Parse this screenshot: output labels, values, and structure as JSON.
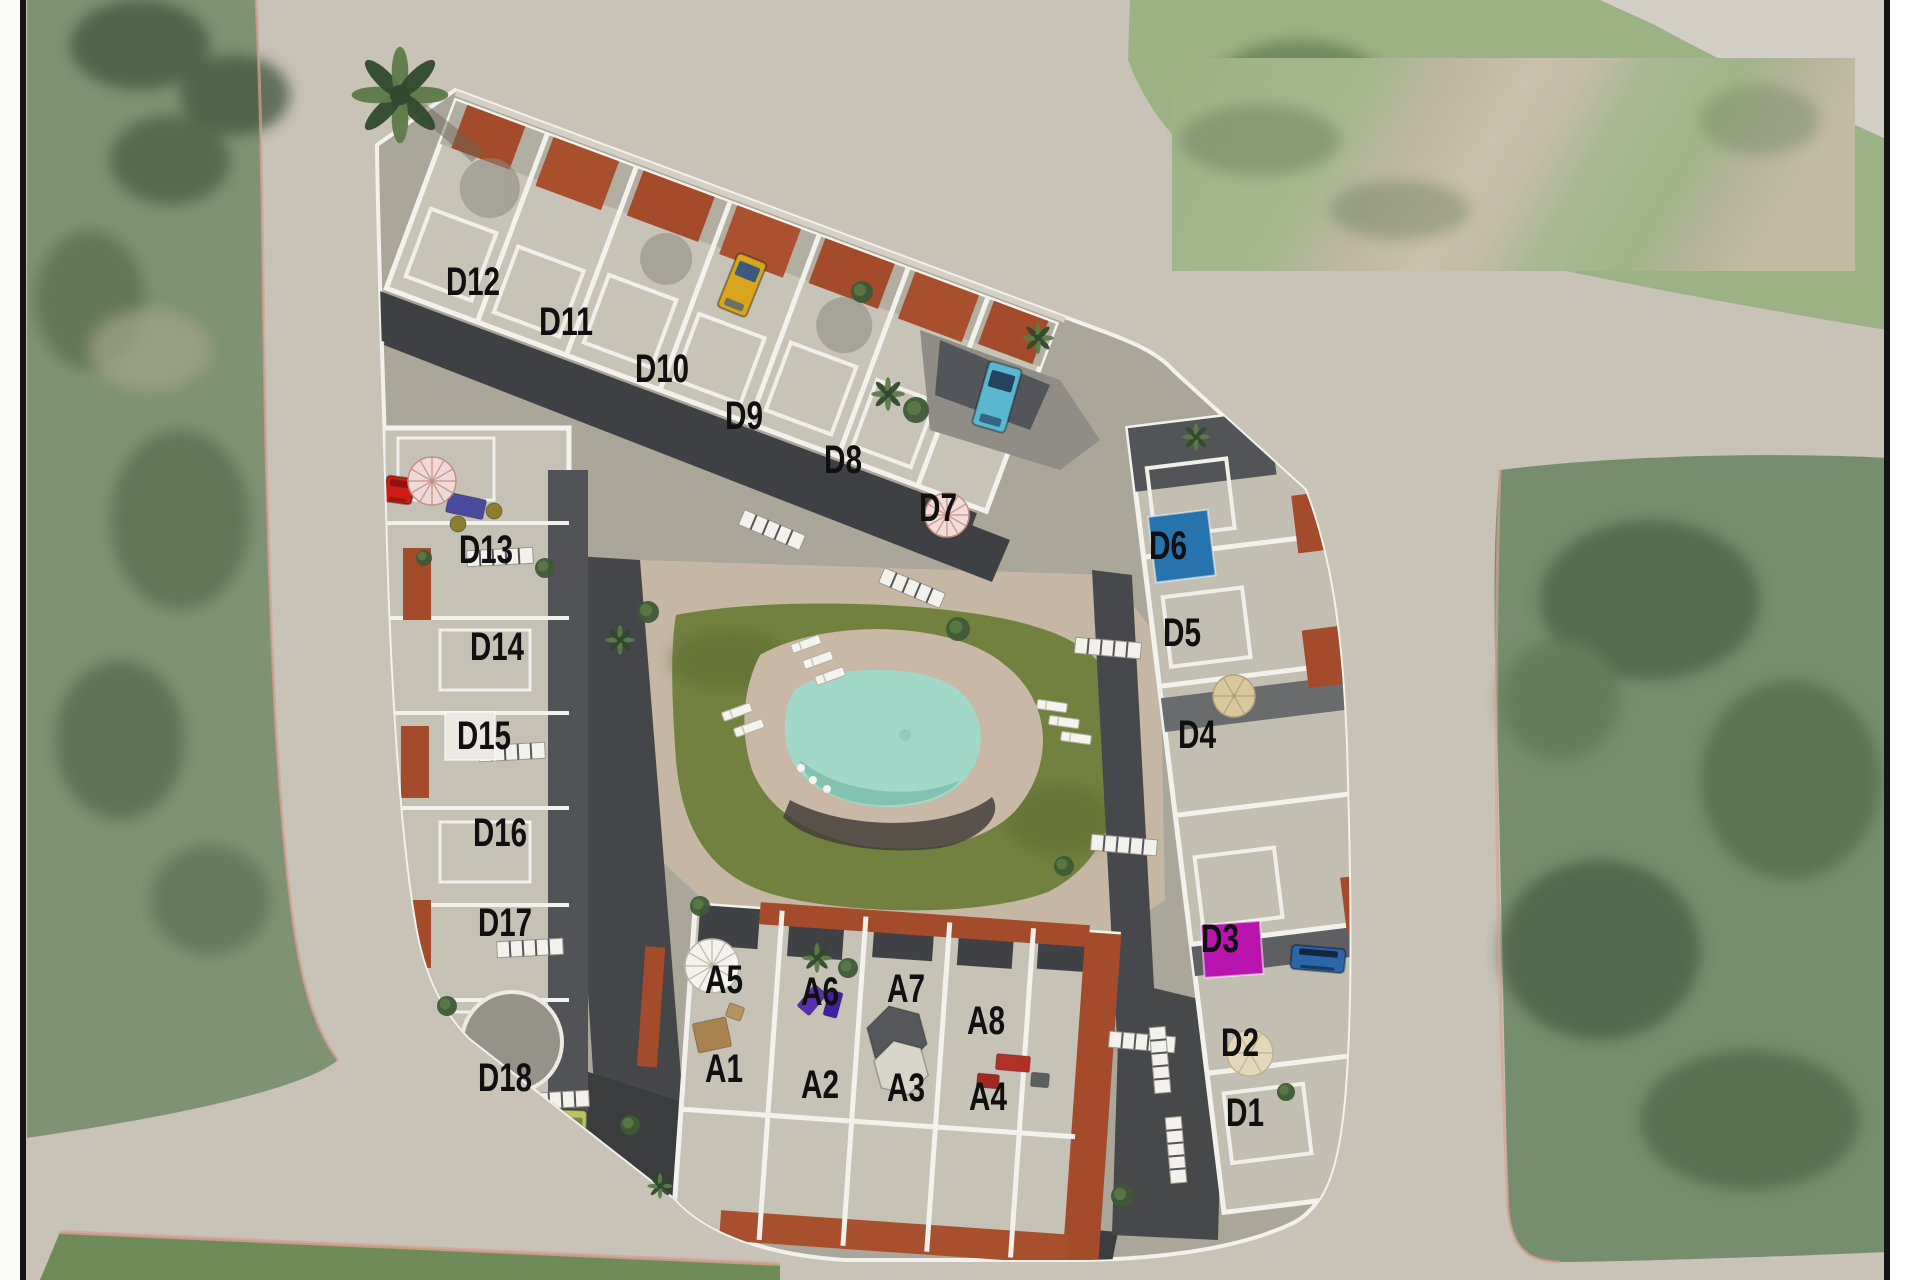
{
  "scene": {
    "width": 1920,
    "height": 1280,
    "kind": "aerial-site-plan",
    "note": "3D rendered residential development over satellite photo with numbered unit labels"
  },
  "palette": {
    "road": "#c8c2b7",
    "road_light": "#d3cfc7",
    "field_left": "#7f9372",
    "field_right": "#768e6b",
    "field_dark": "#4e6547",
    "field_bottom": "#6f8c58",
    "curb_pink": "#d8a193",
    "parcel": "#aaa69a",
    "lane_dark": "#3e4043",
    "building": "#c7c3b6",
    "building_dark": "#b2aea2",
    "wall_white": "#f2f1ec",
    "charcoal": "#4b4d50",
    "charcoal_deep": "#3a3c3e",
    "brick": "#a34b2b",
    "brick_light": "#c06a42",
    "lawn": "#72813f",
    "lawn_dark": "#5d6c33",
    "deck": "#c9b8a5",
    "pool": "#a2d8c8",
    "pool_deep": "#7fc0ae",
    "shadow": "#45403a",
    "label": "#101010",
    "frame_line": "#141414",
    "margin_left": "#fafaf8",
    "margin_right": "#ffffff",
    "palm": "#2f4a2c",
    "bush": "#3e5a36",
    "bush_light": "#5d7a47",
    "paste_green": "#a6b78f",
    "paste_tan": "#c9c1aa"
  },
  "labels": [
    {
      "id": "D12",
      "x": 473,
      "y": 281
    },
    {
      "id": "D11",
      "x": 566,
      "y": 321
    },
    {
      "id": "D10",
      "x": 662,
      "y": 368
    },
    {
      "id": "D9",
      "x": 744,
      "y": 415
    },
    {
      "id": "D8",
      "x": 843,
      "y": 459
    },
    {
      "id": "D7",
      "x": 938,
      "y": 507
    },
    {
      "id": "D13",
      "x": 486,
      "y": 549
    },
    {
      "id": "D14",
      "x": 497,
      "y": 646
    },
    {
      "id": "D15",
      "x": 484,
      "y": 735
    },
    {
      "id": "D16",
      "x": 500,
      "y": 832
    },
    {
      "id": "D17",
      "x": 505,
      "y": 922
    },
    {
      "id": "D18",
      "x": 505,
      "y": 1077
    },
    {
      "id": "D6",
      "x": 1168,
      "y": 545
    },
    {
      "id": "D5",
      "x": 1182,
      "y": 632
    },
    {
      "id": "D4",
      "x": 1197,
      "y": 734
    },
    {
      "id": "D3",
      "x": 1220,
      "y": 938
    },
    {
      "id": "D2",
      "x": 1240,
      "y": 1042
    },
    {
      "id": "D1",
      "x": 1245,
      "y": 1112
    },
    {
      "id": "A5",
      "x": 724,
      "y": 979
    },
    {
      "id": "A6",
      "x": 820,
      "y": 991
    },
    {
      "id": "A7",
      "x": 906,
      "y": 988
    },
    {
      "id": "A8",
      "x": 986,
      "y": 1020
    },
    {
      "id": "A1",
      "x": 724,
      "y": 1068
    },
    {
      "id": "A2",
      "x": 820,
      "y": 1084
    },
    {
      "id": "A3",
      "x": 906,
      "y": 1087
    },
    {
      "id": "A4",
      "x": 988,
      "y": 1096
    }
  ],
  "unit_markers": [
    {
      "name": "unit-marker-d6",
      "x": 1148,
      "y": 517,
      "w": 60,
      "h": 66,
      "rot": -7,
      "color": "#2673ae"
    },
    {
      "name": "unit-marker-d3",
      "x": 1201,
      "y": 925,
      "w": 59,
      "h": 53,
      "rot": -4,
      "color": "#b914ae"
    },
    {
      "name": "unit-marker-d15",
      "x": 445,
      "y": 712,
      "w": 50,
      "h": 48,
      "rot": 0,
      "color": "#ebe9e1"
    }
  ],
  "vehicles": [
    {
      "name": "yellow-car",
      "x": 742,
      "y": 285,
      "w": 31,
      "h": 58,
      "rot": 22,
      "body": "#d9a41e",
      "glass": "#3a5a80"
    },
    {
      "name": "teal-car",
      "x": 997,
      "y": 397,
      "w": 34,
      "h": 66,
      "rot": 16,
      "body": "#5ab7cf",
      "glass": "#24435f"
    },
    {
      "name": "blue-pickup",
      "x": 1318,
      "y": 959,
      "w": 54,
      "h": 24,
      "rot": 5,
      "body": "#2a66a8",
      "glass": "#14263d"
    },
    {
      "name": "lime-car",
      "x": 571,
      "y": 1141,
      "w": 30,
      "h": 62,
      "rot": 2,
      "body": "#b9c266",
      "glass": "#7c8547"
    },
    {
      "name": "red-armchair",
      "x": 399,
      "y": 490,
      "w": 28,
      "h": 26,
      "rot": 8,
      "body": "#ce1d15",
      "glass": "#8e120d"
    }
  ],
  "furniture": [
    {
      "name": "blue-mat",
      "x": 466,
      "y": 506,
      "w": 38,
      "h": 20,
      "rot": 12,
      "color": "#4a4a9e"
    },
    {
      "name": "purple-mat-a6",
      "x": 812,
      "y": 1000,
      "w": 16,
      "h": 28,
      "rot": 40,
      "color": "#5b2db0"
    },
    {
      "name": "purple-mat-a6b",
      "x": 833,
      "y": 1004,
      "w": 14,
      "h": 26,
      "rot": 15,
      "color": "#4020a0"
    },
    {
      "name": "red-table-a4",
      "x": 1013,
      "y": 1063,
      "w": 34,
      "h": 16,
      "rot": 5,
      "color": "#b23127"
    },
    {
      "name": "red-bench-a4",
      "x": 988,
      "y": 1081,
      "w": 22,
      "h": 14,
      "rot": 5,
      "color": "#a02a22"
    },
    {
      "name": "gray-grill-a4",
      "x": 1040,
      "y": 1080,
      "w": 18,
      "h": 14,
      "rot": 5,
      "color": "#5c5e60"
    },
    {
      "name": "rattan-set-a1",
      "x": 712,
      "y": 1035,
      "w": 34,
      "h": 30,
      "rot": -12,
      "color": "#a8824f"
    },
    {
      "name": "rattan-chair-a1",
      "x": 735,
      "y": 1012,
      "w": 16,
      "h": 14,
      "rot": 20,
      "color": "#b69260"
    }
  ],
  "round_tables": [
    {
      "name": "round-table",
      "x": 458,
      "y": 524,
      "r": 8,
      "color": "#8b7e2f"
    },
    {
      "name": "round-table",
      "x": 494,
      "y": 511,
      "r": 8,
      "color": "#8b7e2f"
    }
  ],
  "umbrellas": [
    {
      "name": "pink-umbrella-d13",
      "x": 432,
      "y": 481,
      "r": 24,
      "style": "striped",
      "color": "#f0d9d6",
      "spoke": "#c58f88"
    },
    {
      "name": "pink-umbrella-d7",
      "x": 947,
      "y": 515,
      "r": 22,
      "style": "striped",
      "color": "#f2dcd8",
      "spoke": "#c58f88"
    },
    {
      "name": "beige-umbrella-d4",
      "x": 1234,
      "y": 696,
      "r": 21,
      "style": "solid",
      "color": "#d9c79e",
      "spoke": "#b3a27a"
    },
    {
      "name": "beige-tent-d2",
      "x": 1250,
      "y": 1053,
      "r": 23,
      "style": "solid",
      "color": "#e3d8ba",
      "spoke": "#bfb293"
    },
    {
      "name": "white-fan-a5",
      "x": 712,
      "y": 966,
      "r": 27,
      "style": "striped",
      "color": "#f4f3ee",
      "spoke": "#b9b5a8"
    }
  ],
  "canopies": [
    {
      "name": "tent-canopy-a3-dark",
      "x": 897,
      "y": 1036,
      "r": 31,
      "color": "#55575a"
    },
    {
      "name": "tent-canopy-a3-light",
      "x": 901,
      "y": 1068,
      "r": 28,
      "color": "#d8d5ca"
    }
  ],
  "trees": [
    {
      "x": 400,
      "y": 95,
      "r": 46,
      "type": "palm"
    },
    {
      "x": 888,
      "y": 394,
      "r": 16,
      "type": "palm"
    },
    {
      "x": 916,
      "y": 410,
      "r": 13,
      "type": "bush"
    },
    {
      "x": 1038,
      "y": 338,
      "r": 15,
      "type": "palm"
    },
    {
      "x": 862,
      "y": 292,
      "r": 11,
      "type": "bush"
    },
    {
      "x": 1196,
      "y": 437,
      "r": 13,
      "type": "palm"
    },
    {
      "x": 958,
      "y": 629,
      "r": 12,
      "type": "bush"
    },
    {
      "x": 700,
      "y": 906,
      "r": 10,
      "type": "bush"
    },
    {
      "x": 660,
      "y": 1186,
      "r": 12,
      "type": "palm"
    },
    {
      "x": 1122,
      "y": 1196,
      "r": 11,
      "type": "bush"
    },
    {
      "x": 545,
      "y": 568,
      "r": 10,
      "type": "bush"
    },
    {
      "x": 424,
      "y": 558,
      "r": 8,
      "type": "bush"
    },
    {
      "x": 447,
      "y": 1006,
      "r": 10,
      "type": "bush"
    },
    {
      "x": 620,
      "y": 640,
      "r": 14,
      "type": "palm"
    },
    {
      "x": 648,
      "y": 612,
      "r": 11,
      "type": "bush"
    },
    {
      "x": 1286,
      "y": 1092,
      "r": 9,
      "type": "bush"
    },
    {
      "x": 817,
      "y": 958,
      "r": 14,
      "type": "palm"
    },
    {
      "x": 848,
      "y": 968,
      "r": 10,
      "type": "bush"
    },
    {
      "x": 630,
      "y": 1125,
      "r": 10,
      "type": "bush"
    },
    {
      "x": 1064,
      "y": 866,
      "r": 10,
      "type": "bush"
    }
  ],
  "loungers": [
    {
      "x": 806,
      "y": 644,
      "rot": -20
    },
    {
      "x": 818,
      "y": 660,
      "rot": -20
    },
    {
      "x": 830,
      "y": 676,
      "rot": -20
    },
    {
      "x": 737,
      "y": 712,
      "rot": -20
    },
    {
      "x": 749,
      "y": 728,
      "rot": -20
    },
    {
      "x": 1052,
      "y": 706,
      "rot": 8
    },
    {
      "x": 1064,
      "y": 722,
      "rot": 8
    },
    {
      "x": 1076,
      "y": 738,
      "rot": 8
    }
  ],
  "stairs": [
    {
      "x": 500,
      "y": 557,
      "rot": -3
    },
    {
      "x": 512,
      "y": 752,
      "rot": -3
    },
    {
      "x": 530,
      "y": 948,
      "rot": -3
    },
    {
      "x": 556,
      "y": 1100,
      "rot": -3
    },
    {
      "x": 1108,
      "y": 648,
      "rot": 5
    },
    {
      "x": 1124,
      "y": 845,
      "rot": 5
    },
    {
      "x": 1142,
      "y": 1042,
      "rot": 5
    },
    {
      "x": 772,
      "y": 530,
      "rot": 23
    },
    {
      "x": 912,
      "y": 588,
      "rot": 23
    },
    {
      "x": 1160,
      "y": 1060,
      "rot": 85
    },
    {
      "x": 1176,
      "y": 1150,
      "rot": 85
    }
  ],
  "pasted_patch": {
    "x": 1172,
    "y": 58,
    "w": 683,
    "h": 213
  }
}
